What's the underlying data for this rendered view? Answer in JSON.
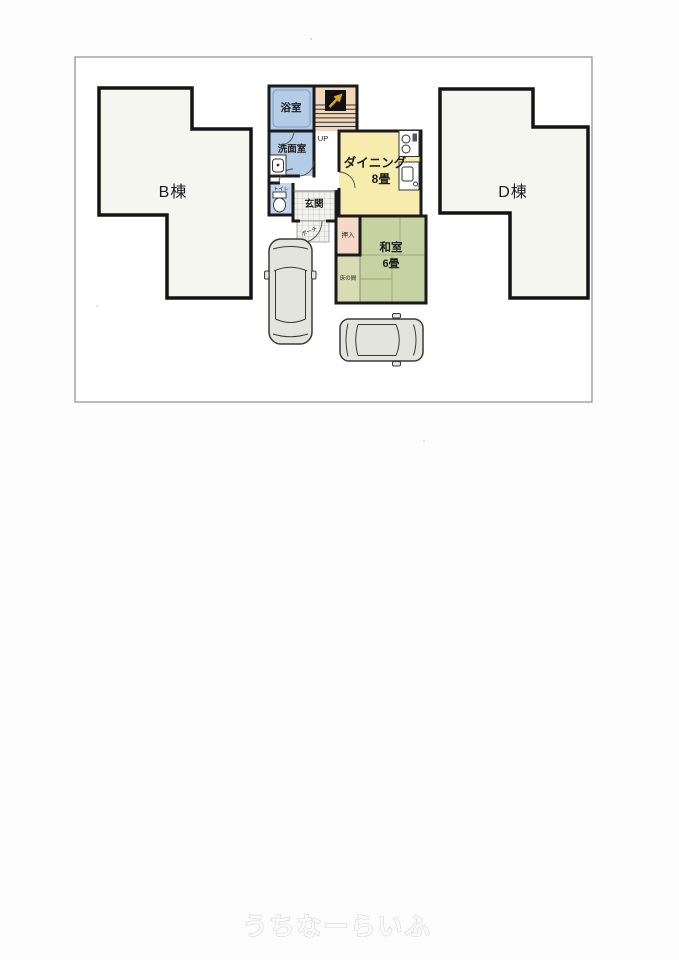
{
  "page": {
    "watermark_text": "うちなーらいふ"
  },
  "buildings": {
    "b": {
      "label": "B棟"
    },
    "d": {
      "label": "D棟"
    }
  },
  "rooms": {
    "bath": {
      "label": "浴室"
    },
    "washroom": {
      "label": "洗面室"
    },
    "toilet": {
      "label": "トイレ"
    },
    "stairs": {
      "up_label": "UP"
    },
    "dining": {
      "label": "ダイニング",
      "size": "8畳"
    },
    "genkan": {
      "label": "玄関"
    },
    "porch": {
      "label": "ポーチ"
    },
    "oshiire": {
      "label": "押入"
    },
    "tokonoma": {
      "label": "床の間"
    },
    "washitsu": {
      "label": "和室",
      "size": "6畳"
    }
  },
  "icons": {
    "north_arrow": "north-arrow-icon",
    "stove": "stove-icon",
    "kitchen_sink": "kitchen-sink-icon",
    "washbasin": "washbasin-icon",
    "toilet_fixture": "toilet-icon",
    "cars": [
      "car-top-view-icon",
      "car-top-view-icon"
    ]
  },
  "colors": {
    "wall": "#1a1a1a",
    "building_fill": "#f6f6f1",
    "bath_blue": "#b5cce6",
    "toilet_blue": "#c4d6ea",
    "stairs_peach": "#f2d8ba",
    "dining_yellow": "#f5ecae",
    "oshiire_pink": "#f4dac6",
    "tokonoma_green": "#d8dcb2",
    "washitsu_green": "#c6d2a2",
    "car_gray": "#e4e4df"
  }
}
